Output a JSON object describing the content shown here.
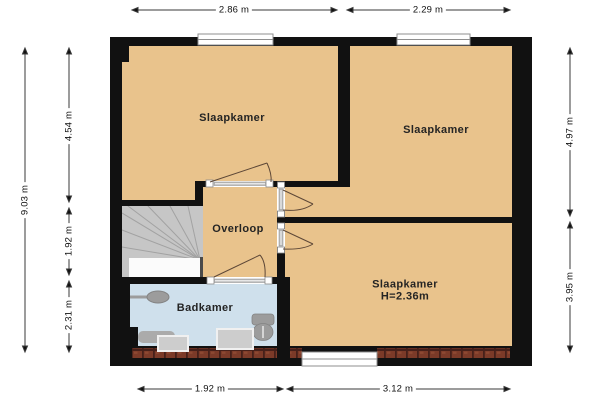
{
  "floorplan": {
    "rooms": {
      "bedroom_top_left": {
        "label": "Slaapkamer"
      },
      "bedroom_top_right": {
        "label": "Slaapkamer"
      },
      "bedroom_bottom_right": {
        "label": "Slaapkamer",
        "height_note": "H=2.36m"
      },
      "landing": {
        "label": "Overloop"
      },
      "bathroom": {
        "label": "Badkamer"
      }
    },
    "dimensions": {
      "top_left_width": "2.86 m",
      "top_right_width": "2.29 m",
      "bottom_left_width": "1.92 m",
      "bottom_right_width": "3.12 m",
      "left_total_height": "9.03 m",
      "left_top": "4.54 m",
      "left_middle": "1.92 m",
      "left_bottom": "2.31 m",
      "right_top": "4.97 m",
      "right_bottom": "3.95 m"
    },
    "colors": {
      "room_fill": "#e9c38c",
      "bathroom_fill": "#cfe0ec",
      "stairs_fill": "#c6c6c6",
      "wall": "#111111",
      "brick": "#7b3a28",
      "fixture_gray": "#9c9c9c"
    }
  }
}
